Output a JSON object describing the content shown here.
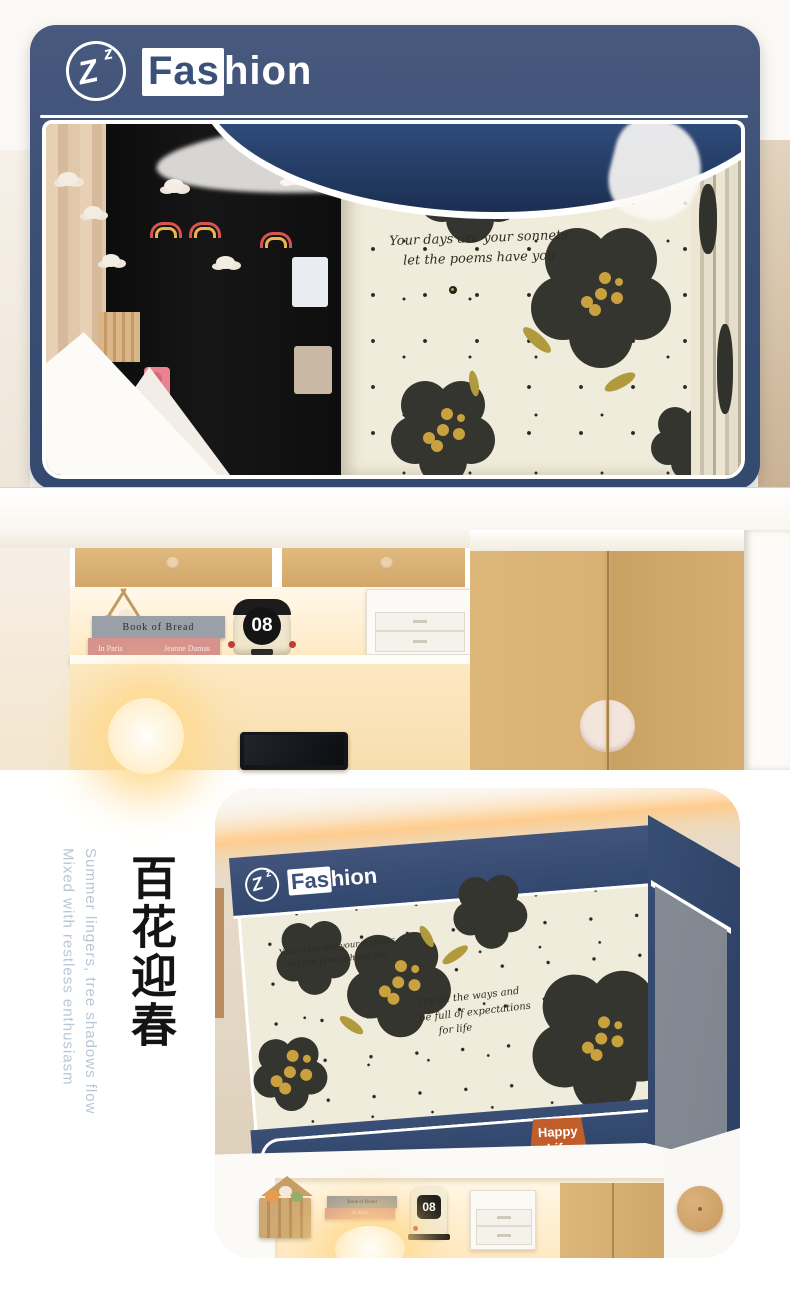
{
  "brand": {
    "wordmark_prefix": "Fas",
    "wordmark_suffix": "hion",
    "logo_z_big": "Z",
    "logo_z_small": "z"
  },
  "colors": {
    "navy": "#3a5179",
    "fabric_cream": "#f0ecdb",
    "flower_dark": "#33352e",
    "flower_center_mustard": "#c9a23f",
    "badge_orange": "#c05d2a",
    "subtitle_gray_blue": "#b9c6d6"
  },
  "top_photo": {
    "quote_line1": "Your days are your sonnets",
    "quote_line2": "let the poems have you",
    "shelf": {
      "book_top": "Book of Bread",
      "book_bottom_title": "In Paris",
      "book_bottom_author": "Jeanne Damas",
      "calendar_number": "08"
    }
  },
  "bottom_section": {
    "vertical_title": "百花迎春",
    "vertical_subtitle_line1": "Summer lingers, tree shadows flow",
    "vertical_subtitle_line2": "Mixed with restless enthusiasm",
    "photo": {
      "quote_line1": "Your days are your sonnets",
      "quote_line2": "let the poems have you",
      "quote2_line1": "Try all the ways and",
      "quote2_line2": "be full of expectations",
      "quote2_line3": "for life",
      "badge_line1": "Happy",
      "badge_line2": "Life",
      "calendar_number": "08"
    }
  }
}
